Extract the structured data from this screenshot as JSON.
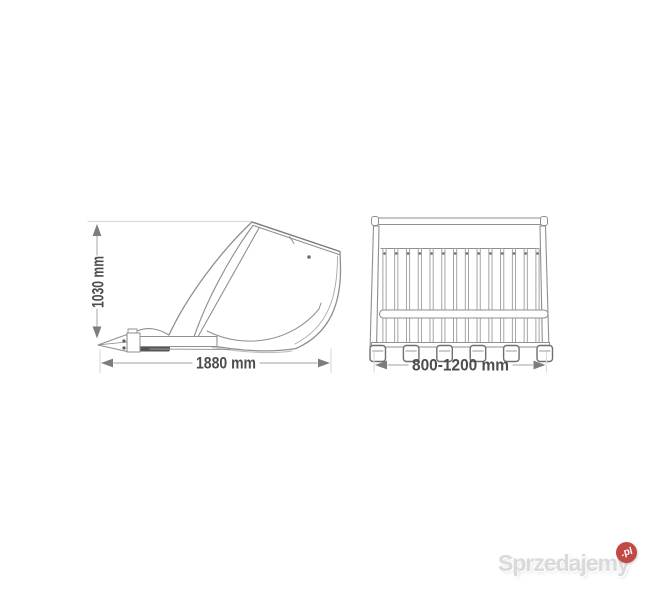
{
  "meta": {
    "description": "Technical line drawing of an excavator skeleton (riddle) bucket: side view and front view with dimensions"
  },
  "side_view": {
    "name": "bucket-side-view",
    "height_label": "1030 mm",
    "width_label": "1880 mm"
  },
  "front_view": {
    "name": "skeleton-bucket-front-view",
    "width_label": "800-1200 mm",
    "bar_count": 14,
    "teeth_count": 6
  },
  "watermark": {
    "brand": "Sprzedajemy",
    "tld": ".pl",
    "badge_color": "#c24843",
    "text_color": "#dadada"
  },
  "colors": {
    "background": "#ffffff",
    "drawing_line": "#8f8f8f",
    "drawing_line_dark": "#6f6f6f",
    "dimension_line": "#b3b3b3",
    "extension_line": "#dcdcdc",
    "arrow": "#7d7d7d",
    "dimension_text": "#4d4d4d"
  }
}
